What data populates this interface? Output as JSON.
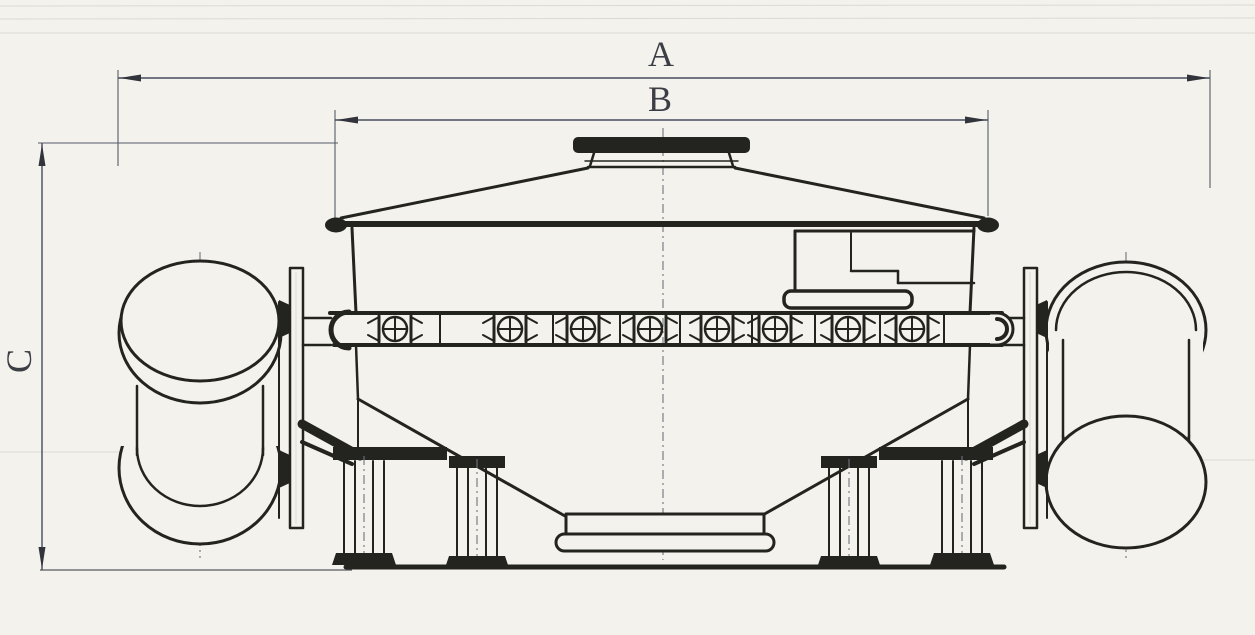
{
  "drawing": {
    "type": "technical-dimension-drawing",
    "subject": "screening-machine-side-view",
    "labels": {
      "dim_a": "A",
      "dim_b": "B",
      "dim_c": "C"
    },
    "colors": {
      "ink": "#24241f",
      "dimension_line": "#474c5c",
      "label_text": "#3c3e46",
      "paper": "#f3f2ed"
    }
  }
}
